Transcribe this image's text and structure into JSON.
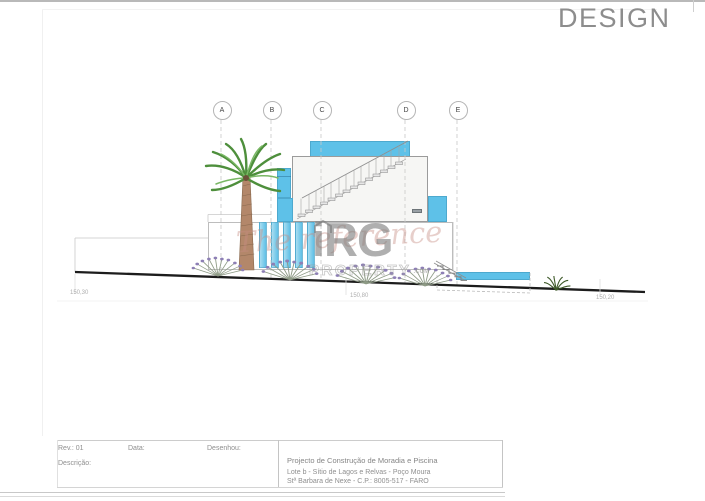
{
  "brand": {
    "text": "DESIGN"
  },
  "drawing": {
    "section_markers": [
      {
        "label": "A"
      },
      {
        "label": "B"
      },
      {
        "label": "C"
      },
      {
        "label": "D"
      },
      {
        "label": "E"
      }
    ],
    "elevation_labels": [
      {
        "text": "150,30"
      },
      {
        "text": "150,80"
      },
      {
        "text": "150,20"
      }
    ],
    "watermark": {
      "tagline": "The reference",
      "logo": "iRG",
      "domain": "PROPERTY",
      "domain_suffix": ".COM"
    },
    "colors": {
      "accent_blue": "#5ec1e8",
      "ground_line": "#1c1c1c"
    }
  },
  "title_block": {
    "rev": "Rev.: 01",
    "data": "Data:",
    "desenhou": "Desenhou:",
    "descricao": "Descrição:",
    "project": "Projecto de Construção de Moradia e Piscina",
    "address1": "Lote b - Sítio de Lagos e Relvas - Poço Moura",
    "address2": "Stª Barbara de Nexe - C.P.: 8005-517 - FARO"
  }
}
